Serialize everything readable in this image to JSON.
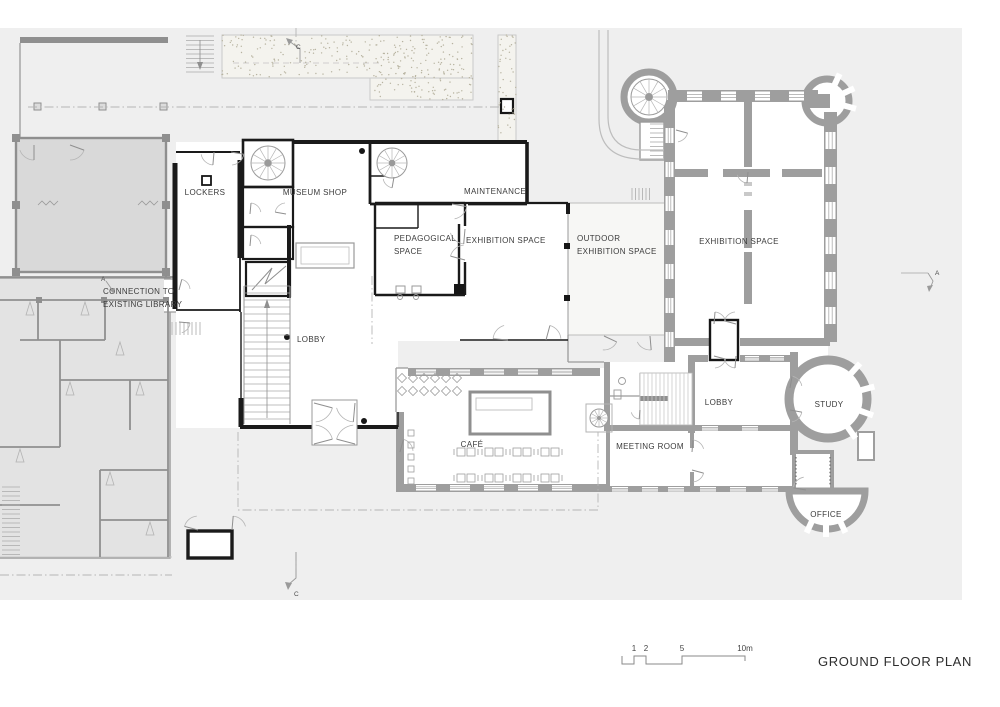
{
  "title": "GROUND FLOOR PLAN",
  "rooms": {
    "lockers": "LOCKERS",
    "museum_shop": "MUSEUM SHOP",
    "maintenance": "MAINTENANCE",
    "pedagogical_line1": "PEDAGOGICAL",
    "pedagogical_line2": "SPACE",
    "exhibition_new": "EXHIBITION SPACE",
    "outdoor_line1": "OUTDOOR",
    "outdoor_line2": "EXHIBITION SPACE",
    "exhibition_old": "EXHIBITION SPACE",
    "lobby_new": "LOBBY",
    "cafe": "CAFÉ",
    "meeting_room": "MEETING ROOM",
    "lobby_old": "LOBBY",
    "study": "STUDY",
    "office": "OFFICE"
  },
  "annotations": {
    "connection_line1": "CONNECTION TO",
    "connection_line2": "EXISTING LIBRARY"
  },
  "section_markers": {
    "left_a": "A",
    "right_a": "A",
    "top_c": "C",
    "bottom_c": "C"
  },
  "scale_bar": {
    "tick_1": "1",
    "tick_2": "2",
    "tick_5": "5",
    "tick_10": "10m"
  },
  "colors": {
    "site": "#efefef",
    "existing_library_fill": "#e3e3e3",
    "library_hall_fill": "#d9d9d9",
    "old_building_wall": "#9e9e9e",
    "new_building_wall": "#1a1a1a",
    "stipple_background": "#f4f3ee",
    "label_text": "#3b3b3b"
  }
}
